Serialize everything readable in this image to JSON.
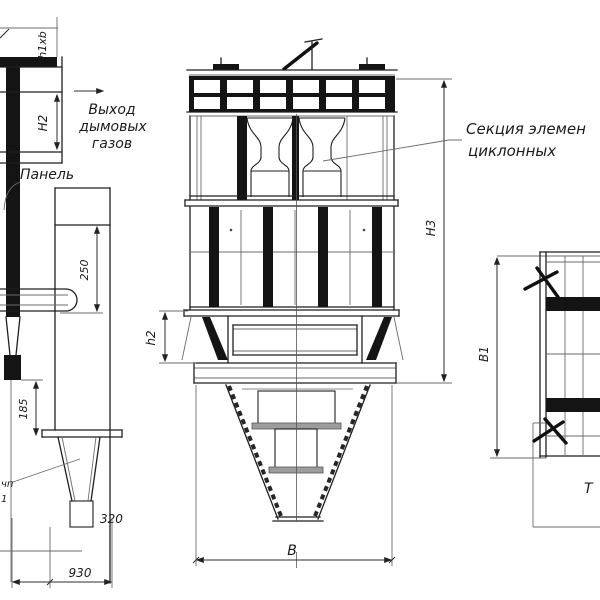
{
  "page": {
    "background": "#ffffff",
    "line_color": "#1c1c1c"
  },
  "labels": {
    "gas_outlet": {
      "line1": "Выход",
      "line2": "дымовых",
      "line3": "газов"
    },
    "panel": "Панель",
    "cyclone_section": {
      "line1": "Секция элемен",
      "line2": "циклонных"
    },
    "left_edge_fragment": {
      "line1": "чп",
      "line2": "1"
    },
    "side_view_fragment": "Т"
  },
  "dimensions": {
    "h1xb": "h1xb",
    "n2": "Н2",
    "s250": "250",
    "h2": "h2",
    "n3": "Н3",
    "s185": "185",
    "s320": "320",
    "s930": "930",
    "b": "В",
    "b1": "В1"
  }
}
